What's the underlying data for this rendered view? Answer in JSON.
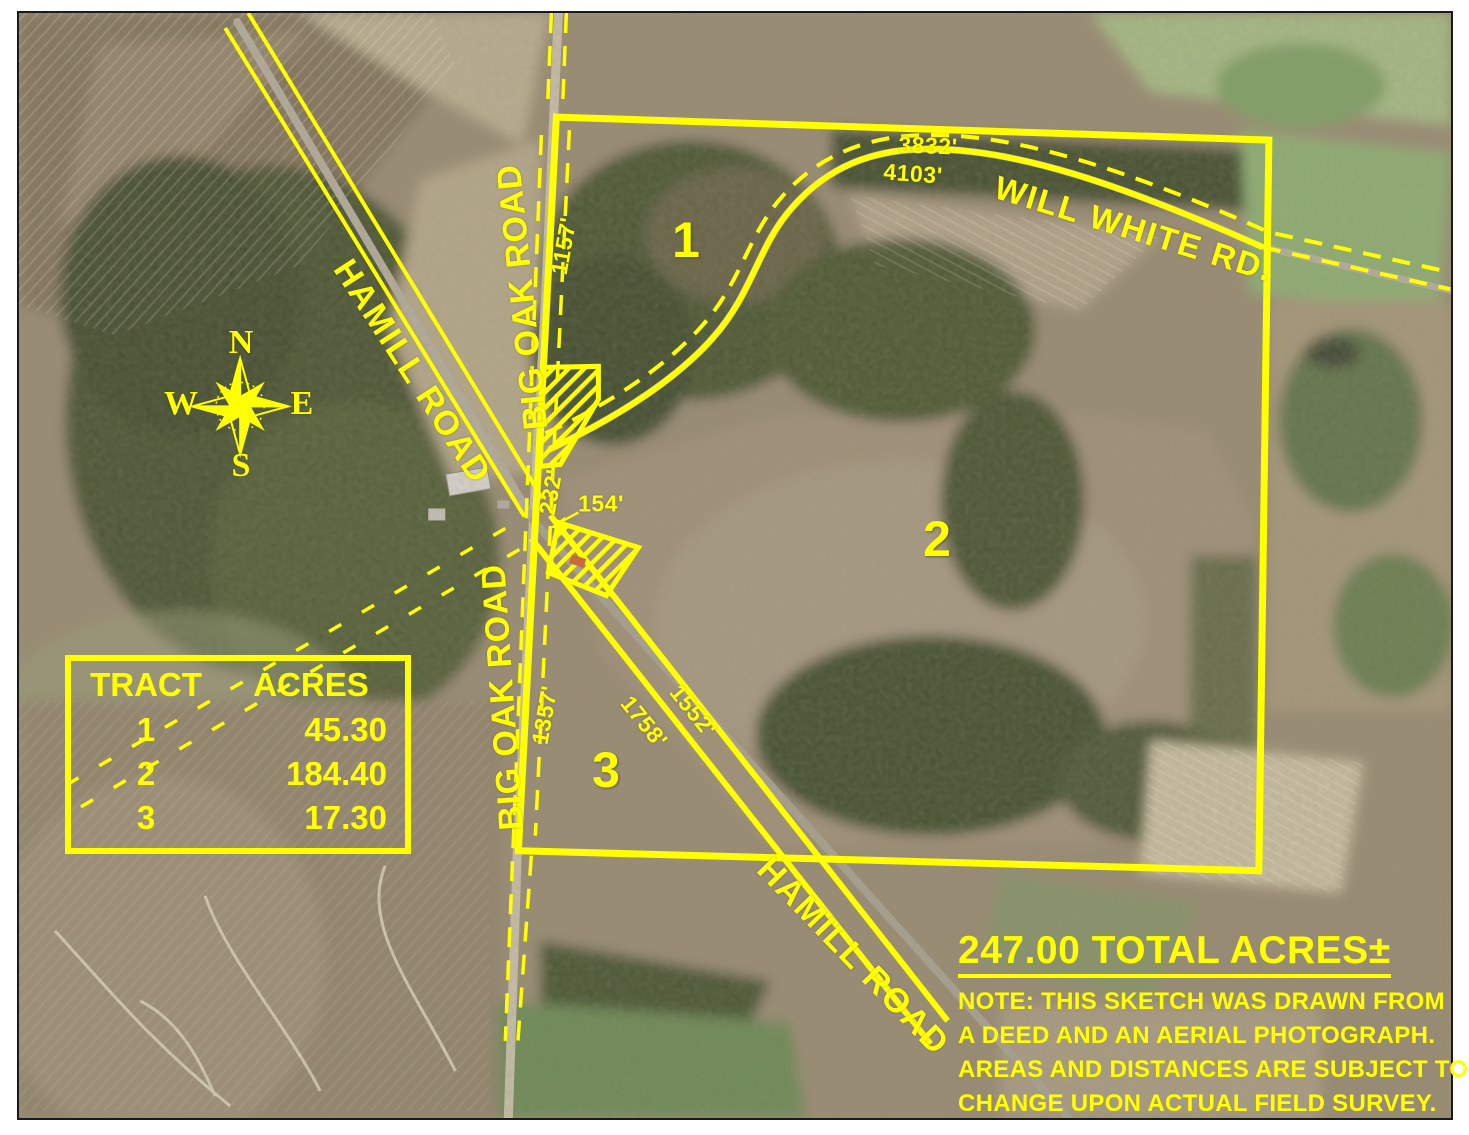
{
  "colors": {
    "annotation": "#ffff00",
    "frame": "#1a1a1a"
  },
  "compass": {
    "n": "N",
    "e": "E",
    "s": "S",
    "w": "W"
  },
  "roads": {
    "hamill_nw_label": "HAMILL ROAD",
    "big_oak_top_label": "BIG OAK ROAD",
    "big_oak_bottom_label": "BIG OAK ROAD",
    "will_white_label": "WILL WHITE RD.",
    "hamill_se_label": "HAMILL ROAD"
  },
  "distances": {
    "north_boundary": "3832'",
    "will_white_road": "4103'",
    "big_oak_tract1": "1157'",
    "big_oak_mid": "232'",
    "excluded_parcel": "154'",
    "big_oak_tract3": "1357'",
    "hamill_tract3_side": "1758'",
    "hamill_tract2_side": "1552'"
  },
  "tracts": [
    {
      "id": "1",
      "acres": "45.30"
    },
    {
      "id": "2",
      "acres": "184.40"
    },
    {
      "id": "3",
      "acres": "17.30"
    }
  ],
  "table": {
    "tract_header": "TRACT",
    "acres_header": "ACRES"
  },
  "summary": {
    "total": "247.00 TOTAL ACRES±",
    "note_lines": [
      "NOTE: THIS SKETCH WAS DRAWN FROM",
      "A DEED AND AN AERIAL PHOTOGRAPH.",
      "AREAS AND DISTANCES ARE SUBJECT TO",
      "CHANGE UPON ACTUAL FIELD SURVEY."
    ]
  }
}
